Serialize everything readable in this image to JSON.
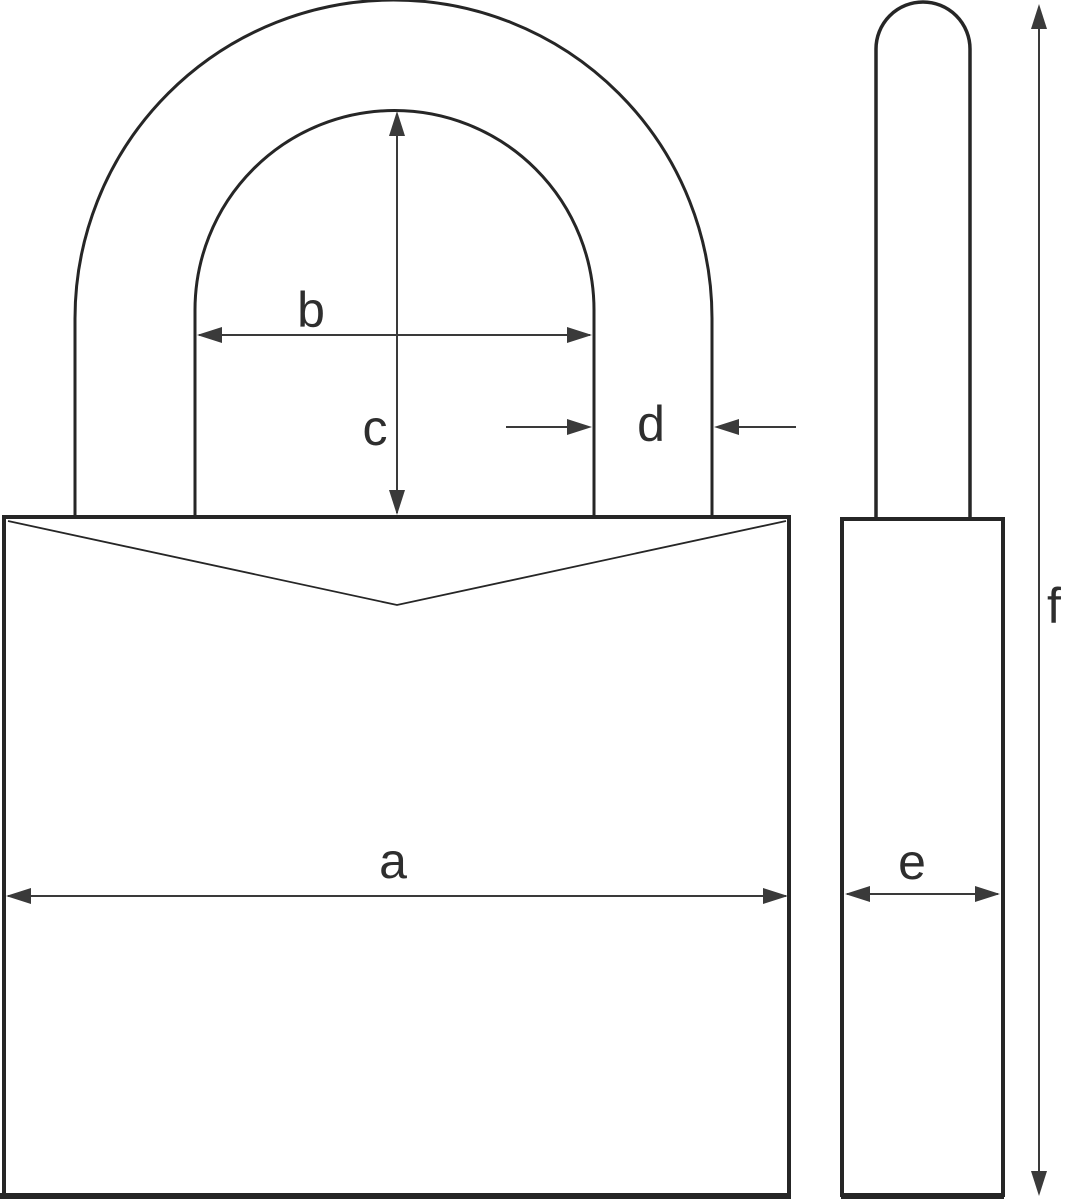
{
  "diagram": {
    "dimension_labels": {
      "a": "a",
      "b": "b",
      "c": "c",
      "d": "d",
      "e": "e",
      "f": "f"
    },
    "colors": {
      "background": "#ffffff",
      "outline": "#262626",
      "dimension": "#3a3a3a",
      "label": "#2e2e2e"
    }
  }
}
